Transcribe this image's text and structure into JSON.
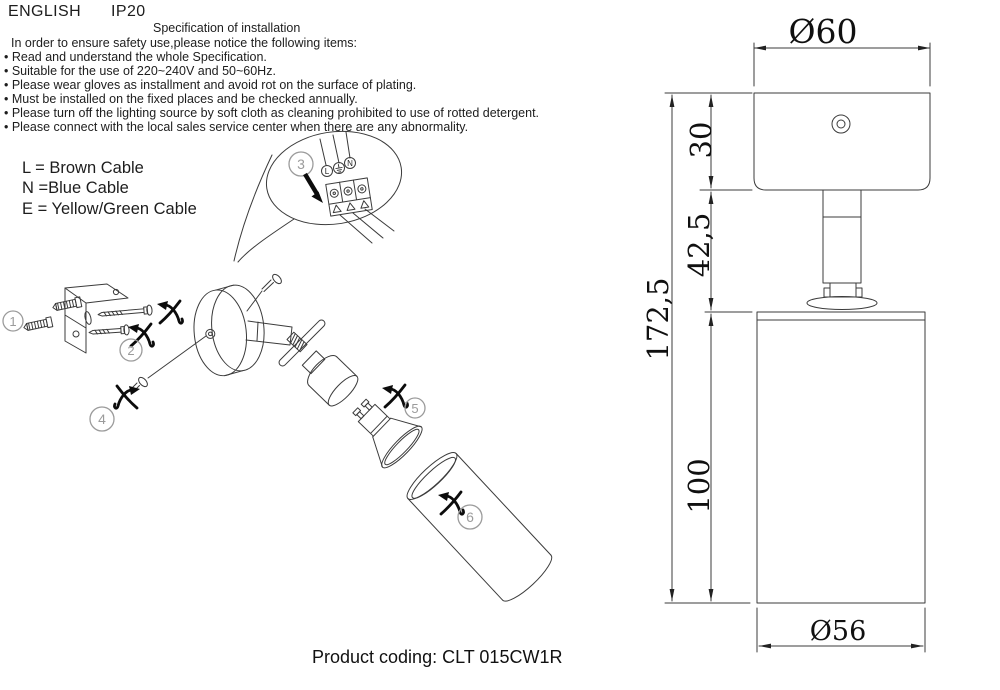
{
  "header": {
    "language": "ENGLISH",
    "ip_rating": "IP20"
  },
  "spec": {
    "title": "Specification of installation",
    "intro": "In order to ensure safety use,please notice the following items:",
    "items": [
      "• Read and understand the whole Specification.",
      "• Suitable for the use of 220~240V and 50~60Hz.",
      "• Please wear gloves as installment and avoid rot on the surface of plating.",
      "• Must be installed on the fixed places and be checked annually.",
      "• Please turn off the lighting source by soft cloth as cleaning prohibited to use of rotted detergent.",
      "• Please connect with the local sales service center when there are any abnormality."
    ]
  },
  "cable_legend": {
    "l": "L = Brown Cable",
    "n": "N =Blue Cable",
    "e": "E = Yellow/Green Cable"
  },
  "wiring_detail": {
    "terminal_l": "L",
    "terminal_n": "N",
    "earth_icon": "earth-ground-symbol"
  },
  "diagram": {
    "parts": [
      "1",
      "2",
      "3",
      "4",
      "5",
      "6"
    ]
  },
  "dimensions": {
    "canopy_diameter": "Ø60",
    "canopy_height": "30",
    "stem_height": "42,5",
    "total_height": "172,5",
    "body_height": "100",
    "body_diameter": "Ø56"
  },
  "footer": {
    "product_coding": "Product coding: CLT 015CW1R"
  },
  "colors": {
    "line": "#3b3b3b",
    "part_label": "#9b9b9b",
    "accent_black": "#0c0c0c"
  }
}
